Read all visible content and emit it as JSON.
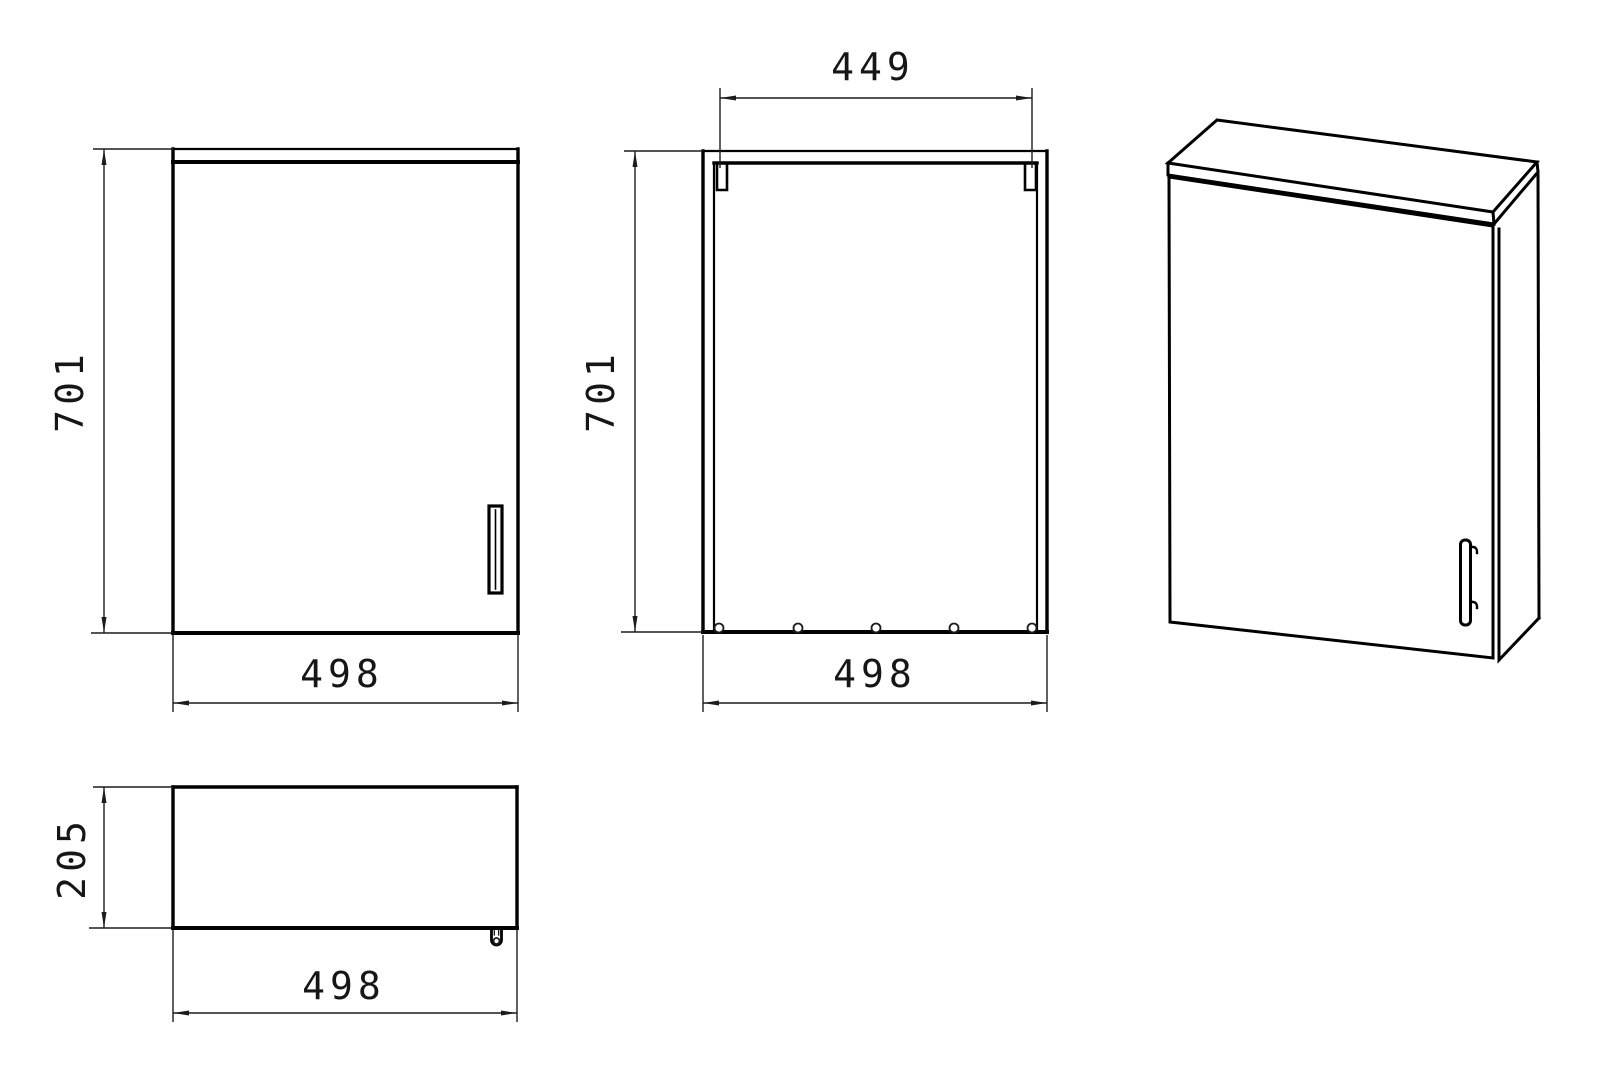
{
  "colors": {
    "background": "#ffffff",
    "line": "#000000",
    "dimension": "#1c1c1c"
  },
  "views": {
    "front": {
      "height": "701",
      "width": "498"
    },
    "back": {
      "bracket_span": "449",
      "height": "701",
      "width": "498"
    },
    "top": {
      "depth": "205",
      "width": "498"
    },
    "perspective": {}
  }
}
